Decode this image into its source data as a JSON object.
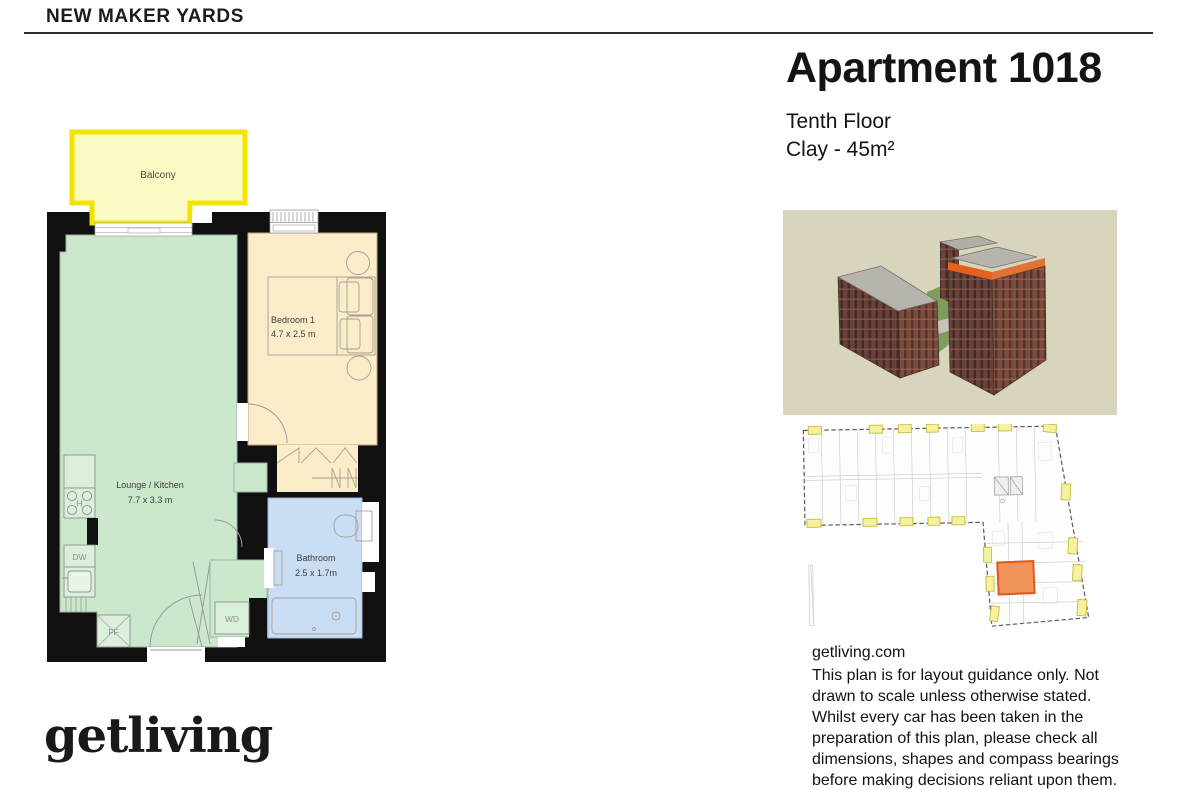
{
  "header": {
    "project": "NEW MAKER YARDS"
  },
  "apartment": {
    "title": "Apartment 1018",
    "floor": "Tenth Floor",
    "spec": "Clay - 45m²"
  },
  "floorplan": {
    "balcony": "Balcony",
    "bedroom": {
      "name": "Bedroom 1",
      "dims": "4.7 x 2.5 m"
    },
    "lounge": {
      "name": "Lounge / Kitchen",
      "dims": "7.7 x 3.3 m"
    },
    "bathroom": {
      "name": "Bathroom",
      "dims": "2.5 x 1.7m"
    },
    "fixtures": {
      "hob": "H",
      "dishwasher": "DW",
      "fridge_freezer": "FF",
      "washer_dryer": "WD"
    }
  },
  "footer": {
    "logo": "getliving",
    "website": "getliving.com",
    "disclaimer": "This plan is for layout guidance only. Not\ndrawn to scale unless otherwise stated.\nWhilst every car has been taken in the\npreparation of this plan, please check all\ndimensions, shapes and compass bearings\nbefore making decisions reliant upon them."
  },
  "colors": {
    "wall": "#101010",
    "lounge": "#cbe8cc",
    "lounge_light": "#daf0da",
    "bedroom": "#fbedca",
    "bed": "#fcf3d9",
    "bathroom": "#c9def5",
    "bath_tub": "#dcebfc",
    "balcony_fill": "#fbfbc6",
    "balcony_border": "#f2e400",
    "render_bg": "#d8d5bc",
    "accent_orange": "#e2611f",
    "unit_highlight": "#f0945c",
    "unit_border": "#dd5a1d",
    "tag_yellow": "#f5f1a0"
  }
}
